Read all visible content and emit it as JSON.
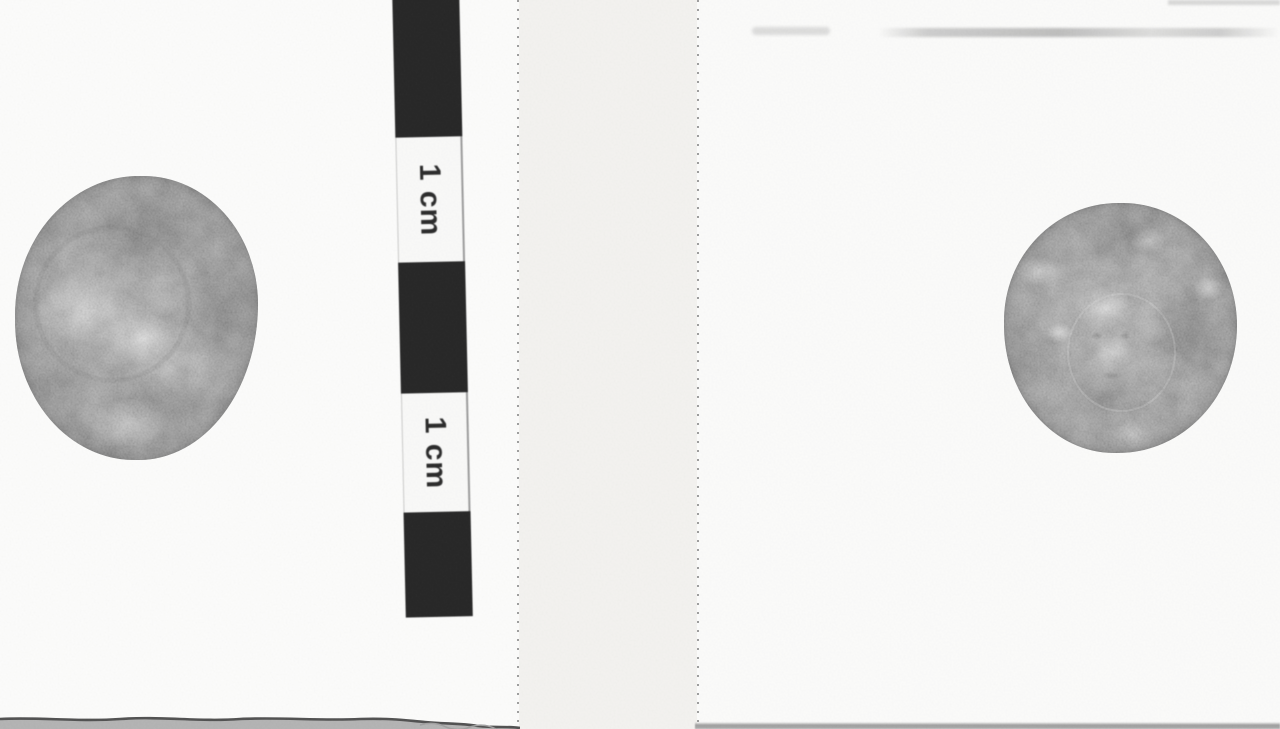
{
  "photo": {
    "description": "Grayscale photograph of the obverse and reverse of a small ancient coin, mounted on cards with a centimeter scale strip",
    "scale_bar": {
      "labels": [
        "1 cm",
        "1 cm"
      ]
    },
    "coins": {
      "left": "coin obverse (head right)",
      "right": "coin reverse (facing head)"
    }
  },
  "colors": {
    "paper_white": "#fdfdfc",
    "strip_gray": "#f4f3f0",
    "bar_black": "#232323",
    "perforation_dot": "#8c8c8c",
    "coin_gray": "#909090"
  }
}
